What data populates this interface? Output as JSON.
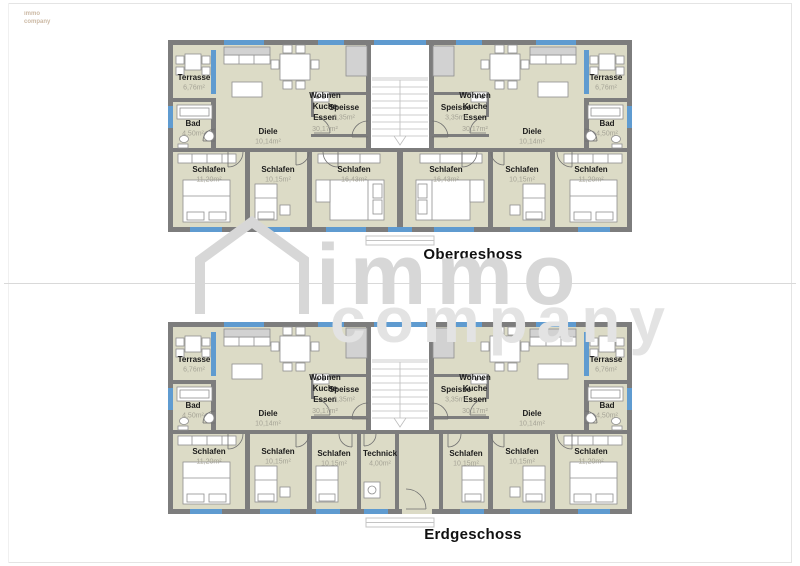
{
  "corner_logo": {
    "line1": "immo",
    "line2": "company"
  },
  "watermark": {
    "word1": "immo",
    "word2": "company"
  },
  "floors": [
    {
      "title": "Obergeshoss",
      "rooms": {
        "terrasse_l": {
          "name": "Terrasse",
          "area": "6,76m²"
        },
        "terrasse_r": {
          "name": "Terrasse",
          "area": "6,76m²"
        },
        "wohnen_l": {
          "lines": [
            "Wohnen",
            "Kuche",
            "Essen"
          ],
          "area": "30,17m²"
        },
        "wohnen_r": {
          "lines": [
            "Wohnen",
            "Kuche",
            "Essen"
          ],
          "area": "30,17m²"
        },
        "speisse_l": {
          "name": "Speisse",
          "area": "3,35m²"
        },
        "speisse_r": {
          "name": "Speisse",
          "area": "3,35m²"
        },
        "bad_l": {
          "name": "Bad",
          "area": "4,50m²"
        },
        "bad_r": {
          "name": "Bad",
          "area": "4,50m²"
        },
        "diele_l": {
          "name": "Diele",
          "area": "10,14m²"
        },
        "diele_r": {
          "name": "Diele",
          "area": "10,14m²"
        },
        "schlafen_l1": {
          "name": "Schlafen",
          "area": "11,20m²"
        },
        "schlafen_l2": {
          "name": "Schlafen",
          "area": "10,15m²"
        },
        "schlafen_l3": {
          "name": "Schlafen",
          "area": "16,43m²"
        },
        "schlafen_r3": {
          "name": "Schlafen",
          "area": "16,43m²"
        },
        "schlafen_r2": {
          "name": "Schlafen",
          "area": "10,15m²"
        },
        "schlafen_r1": {
          "name": "Schlafen",
          "area": "11,20m²"
        }
      }
    },
    {
      "title": "Erdgeschoss",
      "rooms": {
        "terrasse_l": {
          "name": "Terrasse",
          "area": "6,76m²"
        },
        "terrasse_r": {
          "name": "Terrasse",
          "area": "6,76m²"
        },
        "wohnen_l": {
          "lines": [
            "Wohnen",
            "Kuche",
            "Essen"
          ],
          "area": "30,17m²"
        },
        "wohnen_r": {
          "lines": [
            "Wohnen",
            "Kuche",
            "Essen"
          ],
          "area": "30,17m²"
        },
        "speisse_l": {
          "name": "Speisse",
          "area": "3,35m²"
        },
        "speisse_r": {
          "name": "Speisse",
          "area": "3,35m²"
        },
        "bad_l": {
          "name": "Bad",
          "area": "4,50m²"
        },
        "bad_r": {
          "name": "Bad",
          "area": "4,50m²"
        },
        "diele_l": {
          "name": "Diele",
          "area": "10,14m²"
        },
        "diele_r": {
          "name": "Diele",
          "area": "10,14m²"
        },
        "schlafen_l1": {
          "name": "Schlafen",
          "area": "11,20m²"
        },
        "schlafen_l2": {
          "name": "Schlafen",
          "area": "10,15m²"
        },
        "schlafen_l3": {
          "name": "Schlafen",
          "area": "10,15m²"
        },
        "technick": {
          "name": "Technick",
          "area": "4,00m²"
        },
        "schlafen_r3": {
          "name": "Schlafen",
          "area": "10,15m²"
        },
        "schlafen_r2": {
          "name": "Schlafen",
          "area": "10,15m²"
        },
        "schlafen_r1": {
          "name": "Schlafen",
          "area": "11,20m²"
        }
      }
    }
  ],
  "colors": {
    "floor": "#dcdbc6",
    "wall": "#7d7d7d",
    "window": "#5f9bd0",
    "watermark": "#d7d7d7"
  }
}
